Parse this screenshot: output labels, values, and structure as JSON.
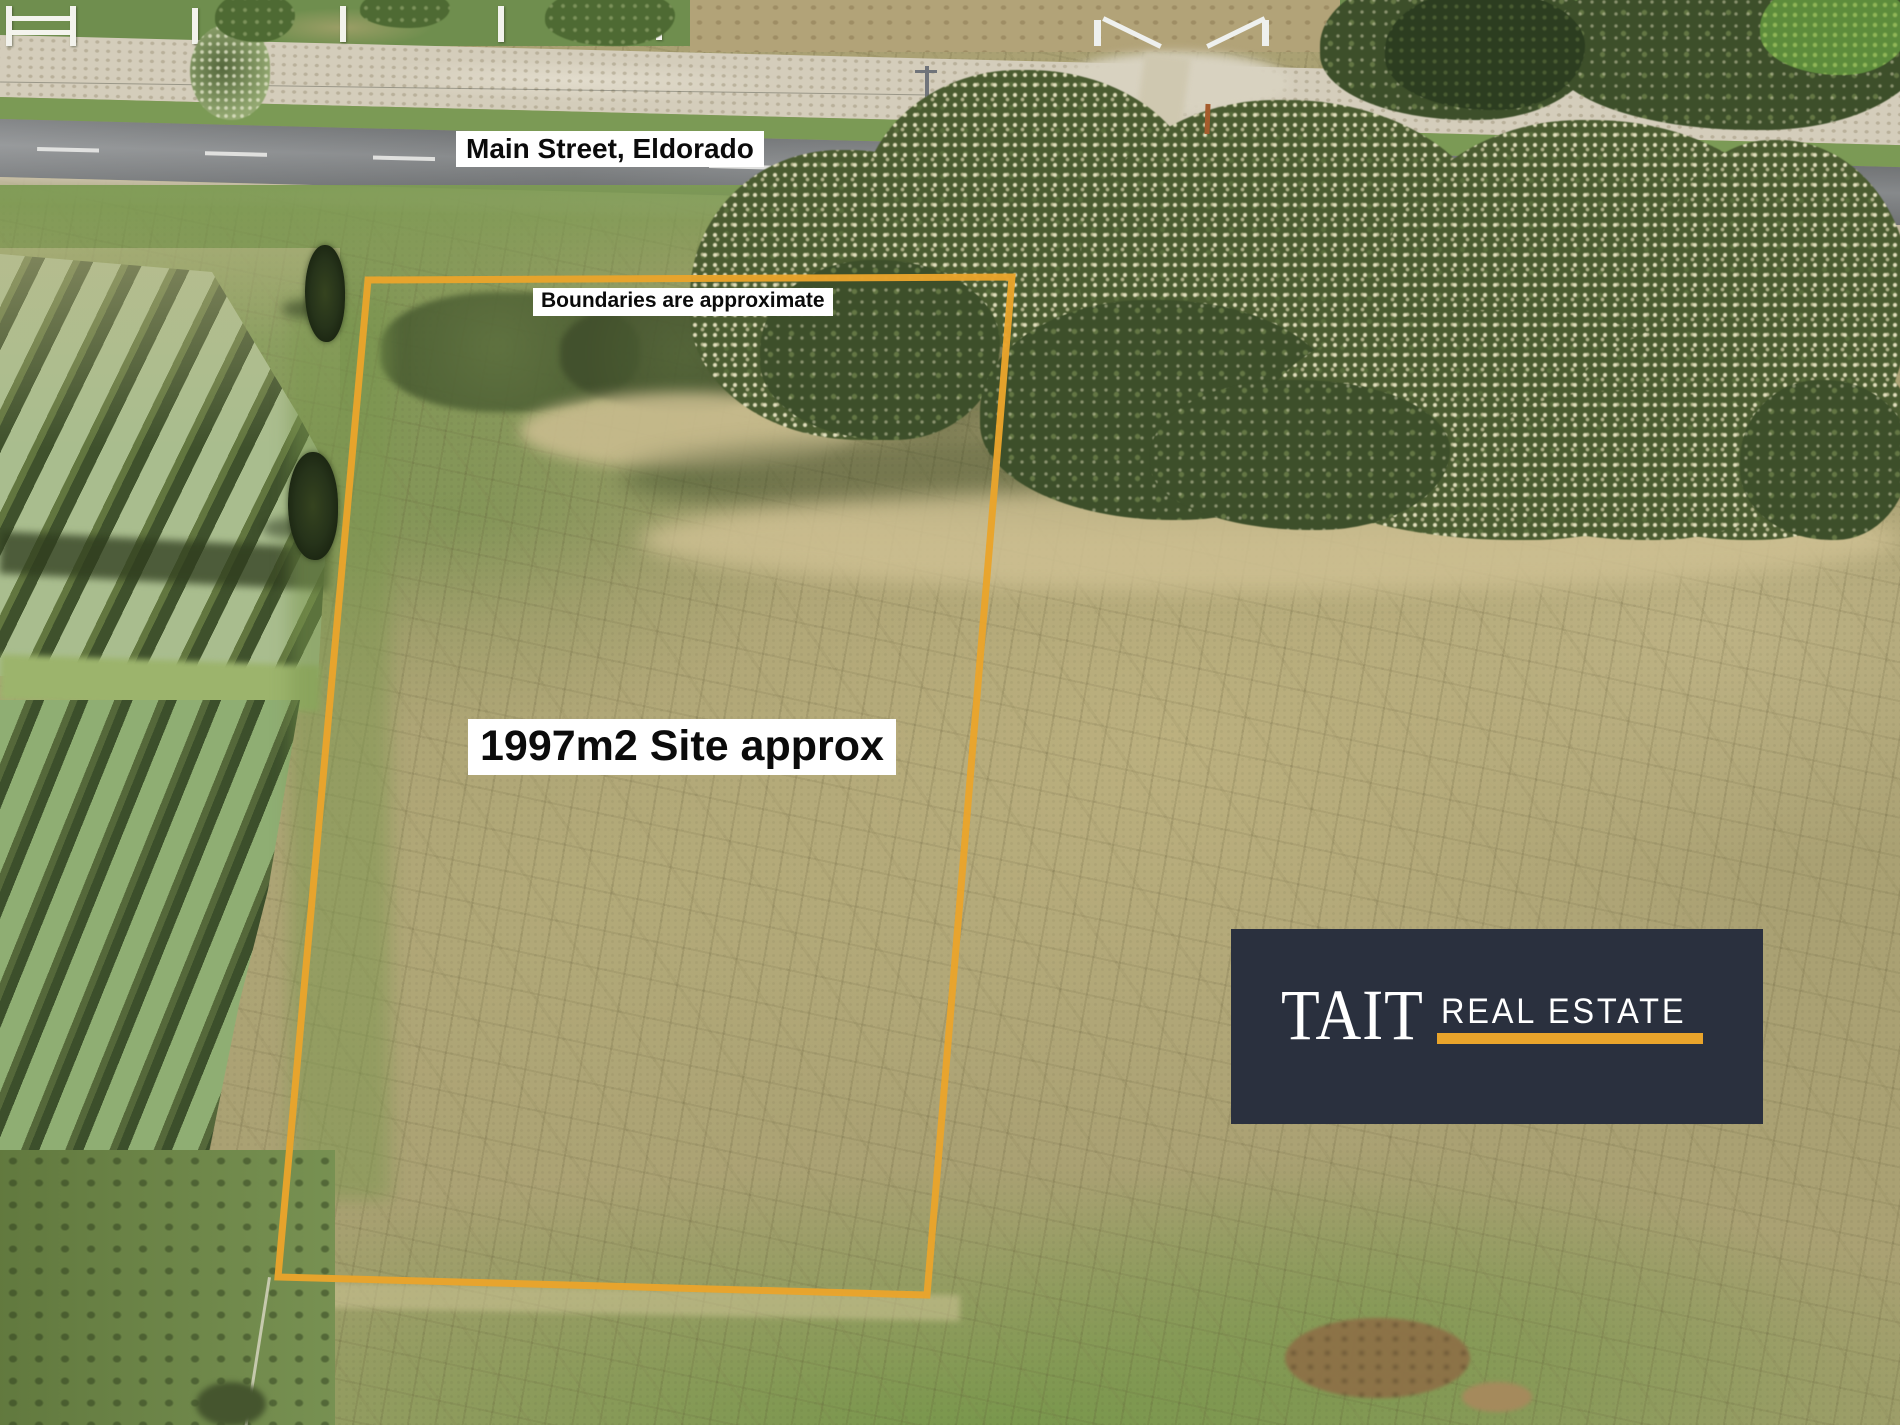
{
  "annotations": {
    "street_label": "Main Street, Eldorado",
    "boundary_note": "Boundaries are approximate",
    "site_area_label": "1997m2 Site approx"
  },
  "boundary": {
    "points": "368,280 1012,277 927,1295 278,1277",
    "stroke_width": "7",
    "color": "#E9A42B"
  },
  "branding": {
    "name": "TAIT",
    "tagline": "REAL ESTATE"
  },
  "colors": {
    "accent": "#E9A42B",
    "panel": "#2A303E",
    "boundary": "#E9A42B",
    "label-bg": "#FFFFFF",
    "label-fg": "#0B0B0B"
  }
}
